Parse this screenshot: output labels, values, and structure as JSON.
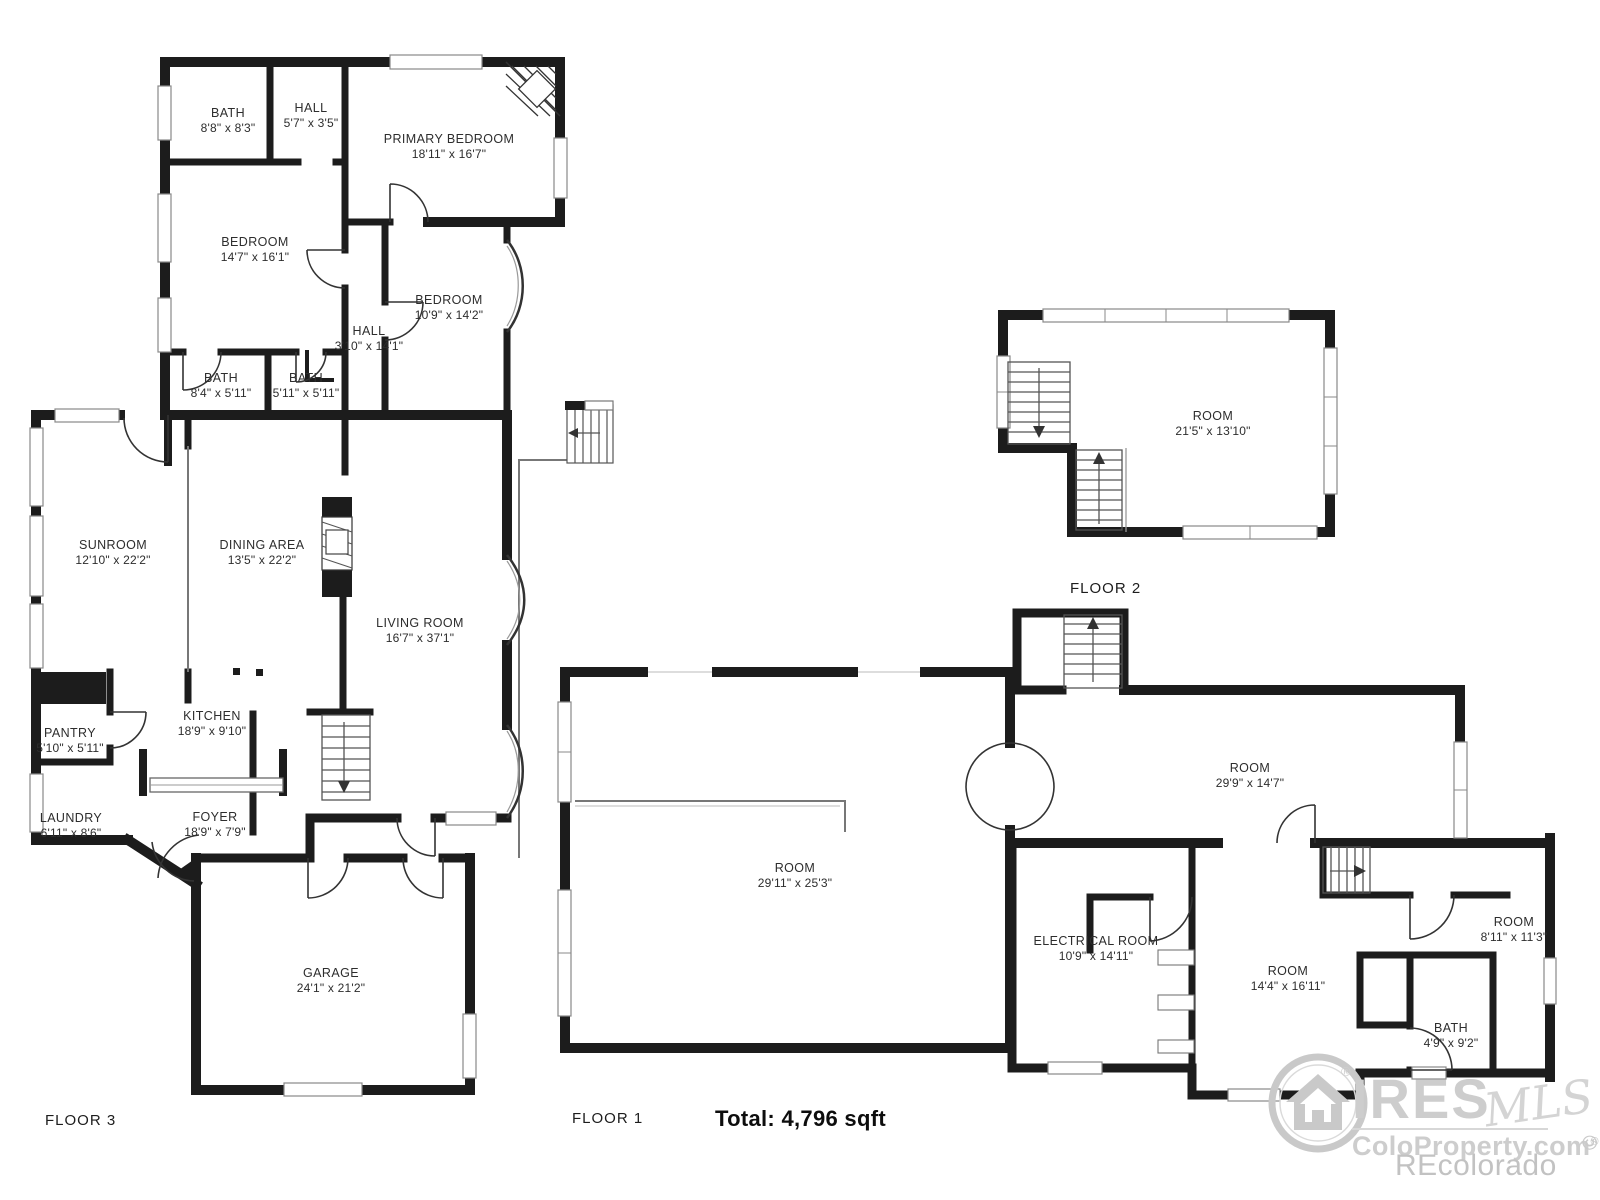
{
  "floors": [
    {
      "label": "FLOOR 3",
      "rooms": [
        {
          "name": "BATH",
          "dims": "8'8\" x 8'3\""
        },
        {
          "name": "HALL",
          "dims": "5'7\" x 3'5\""
        },
        {
          "name": "PRIMARY BEDROOM",
          "dims": "18'11\" x 16'7\""
        },
        {
          "name": "BEDROOM",
          "dims": "14'7\" x 16'1\""
        },
        {
          "name": "BEDROOM",
          "dims": "10'9\" x 14'2\""
        },
        {
          "name": "HALL",
          "dims": "3'10\" x 14'1\""
        },
        {
          "name": "BATH",
          "dims": "8'4\" x 5'11\""
        },
        {
          "name": "BATH",
          "dims": "5'11\" x 5'11\""
        },
        {
          "name": "SUNROOM",
          "dims": "12'10\" x 22'2\""
        },
        {
          "name": "DINING AREA",
          "dims": "13'5\" x 22'2\""
        },
        {
          "name": "LIVING ROOM",
          "dims": "16'7\" x 37'1\""
        },
        {
          "name": "KITCHEN",
          "dims": "18'9\" x 9'10\""
        },
        {
          "name": "PANTRY",
          "dims": "5'10\" x 5'11\""
        },
        {
          "name": "LAUNDRY",
          "dims": "6'11\" x 8'6\""
        },
        {
          "name": "FOYER",
          "dims": "18'9\" x 7'9\""
        },
        {
          "name": "GARAGE",
          "dims": "24'1\" x 21'2\""
        }
      ]
    },
    {
      "label": "FLOOR 2",
      "rooms": [
        {
          "name": "ROOM",
          "dims": "21'5\" x 13'10\""
        }
      ]
    },
    {
      "label": "FLOOR 1",
      "rooms": [
        {
          "name": "ROOM",
          "dims": "29'11\" x 25'3\""
        },
        {
          "name": "ROOM",
          "dims": "29'9\" x 14'7\""
        },
        {
          "name": "ELECTRICAL ROOM",
          "dims": "10'9\" x 14'11\""
        },
        {
          "name": "ROOM",
          "dims": "14'4\" x 16'11\""
        },
        {
          "name": "ROOM",
          "dims": "8'11\" x 11'3\""
        },
        {
          "name": "BATH",
          "dims": "4'9\" x 9'2\""
        }
      ]
    }
  ],
  "summary": {
    "total": "Total: 4,796 sqft"
  },
  "watermark": {
    "brand": "IRES",
    "brand_reg": "®",
    "mls": "MLS",
    "site": "ColoProperty.com",
    "site_reg": "®",
    "vertical": "© IRES",
    "recolorado": "REcolorado"
  },
  "colors": {
    "wall": "#1c1c1c",
    "watermark": "#cdcdcd",
    "background": "#ffffff"
  }
}
